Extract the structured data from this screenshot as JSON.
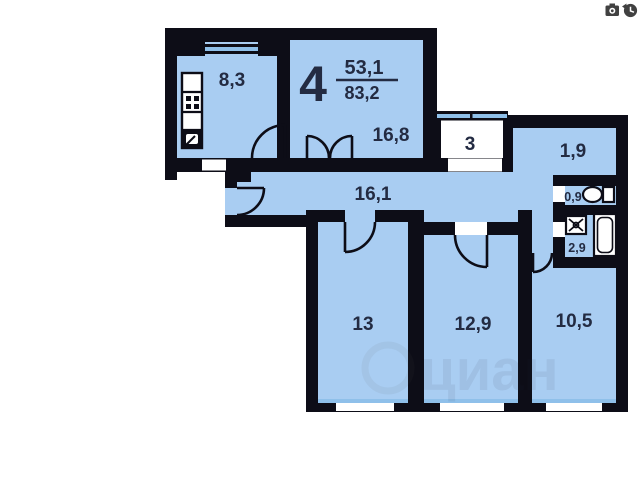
{
  "plan": {
    "rooms_count": "4",
    "area_living": "53,1",
    "area_total": "83,2",
    "labels": {
      "kitchen": "8,3",
      "living_room": "16,8",
      "balcony": "3",
      "hall_nook": "1,9",
      "corridor": "16,1",
      "wc": "0,9",
      "bathroom": "2,9",
      "bedroom_1": "13",
      "bedroom_2": "12,9",
      "bedroom_3": "10,5"
    },
    "watermark_text": "циан",
    "colors": {
      "floor": "#a9cdf2",
      "wall": "#0d0d17",
      "label": "#232b42",
      "window": "#8fc0ea"
    },
    "overlay_icons": [
      "camera-icon",
      "history-icon"
    ]
  }
}
